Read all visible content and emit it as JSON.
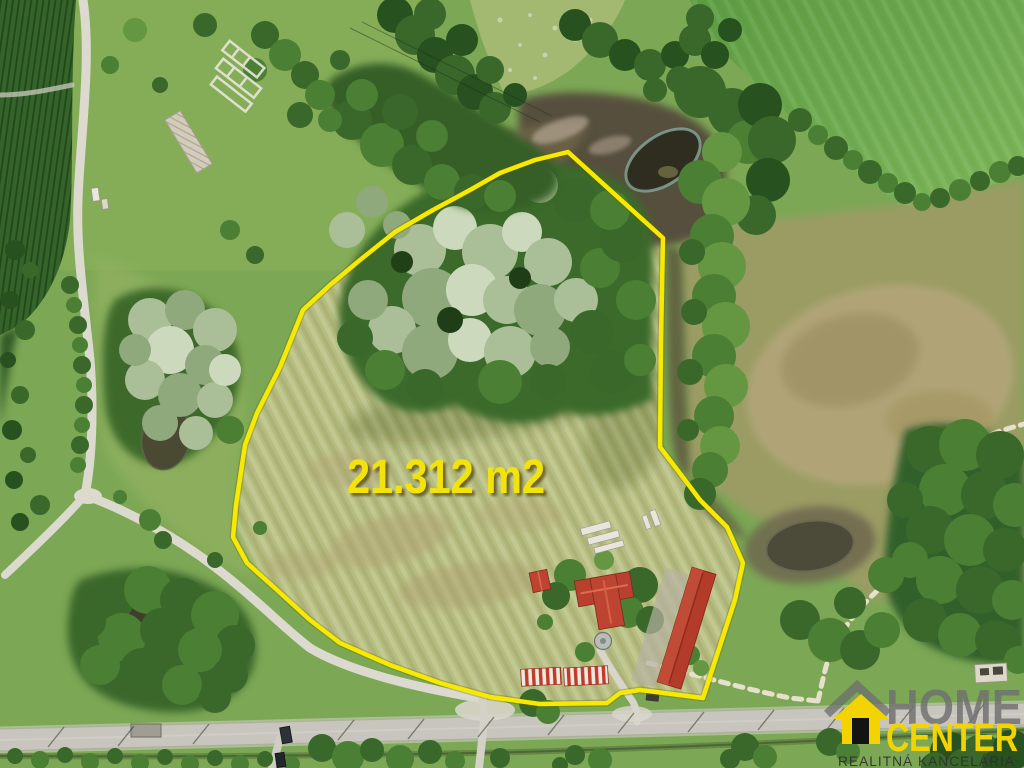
{
  "overlay": {
    "area_label": "21.312 m2",
    "boundary_color": "#f5ea00",
    "label_color": "#f2e30c"
  },
  "logo": {
    "name": "HOME CENTER",
    "line1": "HOME",
    "line2": "CENTER",
    "tagline": "REALITNÁ KANCELÁRIA",
    "house_icon": "house-with-door-icon",
    "colors": {
      "yellow": "#f4d303",
      "gray": "#6f6f6f",
      "tagline_dark": "#2f2f2f",
      "door": "#131313"
    }
  },
  "scene": {
    "type": "aerial-drone-photo-of-land-plot",
    "palette": {
      "grass": "#7ca755",
      "plot_meadow": "#b6bd80",
      "corn_field": "#35642a",
      "field_top_right": "#67a74a",
      "scrub": "#9a9c63",
      "dry_patch": "#b0a477",
      "tree_dark": "#27511f",
      "willow_light": "#cdd9bd",
      "dirt_road": "#dcd9ce",
      "paved_road": "#c7c5bd",
      "pond": "#2f2d1f",
      "roof_red": "#b73b2a"
    }
  }
}
